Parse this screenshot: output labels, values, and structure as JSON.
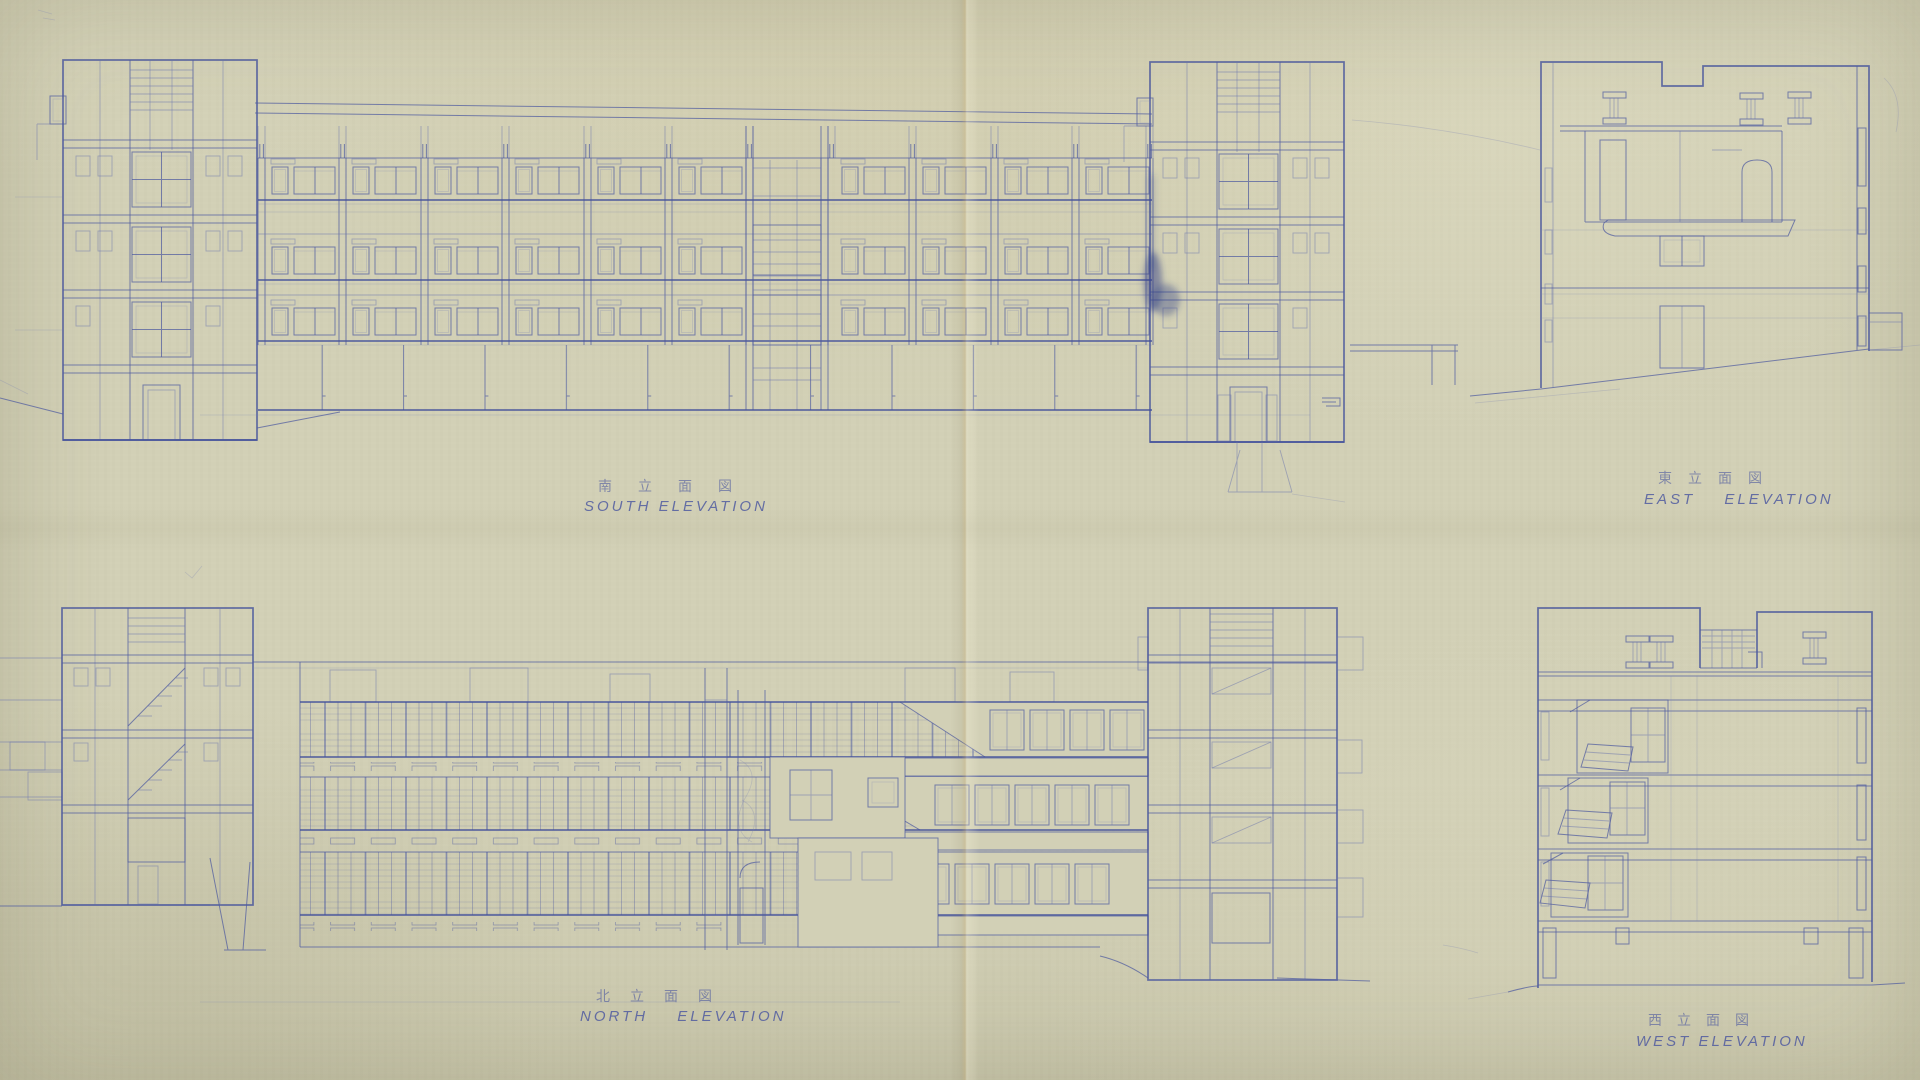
{
  "palette": {
    "paper": "#d2d0b6",
    "ink": "#4d5aa0",
    "ink_dark": "#44519b",
    "ink_light": "#6a74ad",
    "ink_faint": "#7d85b3",
    "crease": "#baa068",
    "ink_smudge": "#2f3e86"
  },
  "panels": [
    {
      "id": "south-elevation",
      "jp_label": "南立面図",
      "en_label": "SOUTH ELEVATION"
    },
    {
      "id": "east-elevation",
      "jp_label": "東立面図",
      "en_label": "EAST ELEVATION"
    },
    {
      "id": "north-elevation",
      "jp_label": "北立面図",
      "en_label": "NORTH ELEVATION"
    },
    {
      "id": "west-elevation",
      "jp_label": "西立面図",
      "en_label": "WEST ELEVATION"
    }
  ]
}
